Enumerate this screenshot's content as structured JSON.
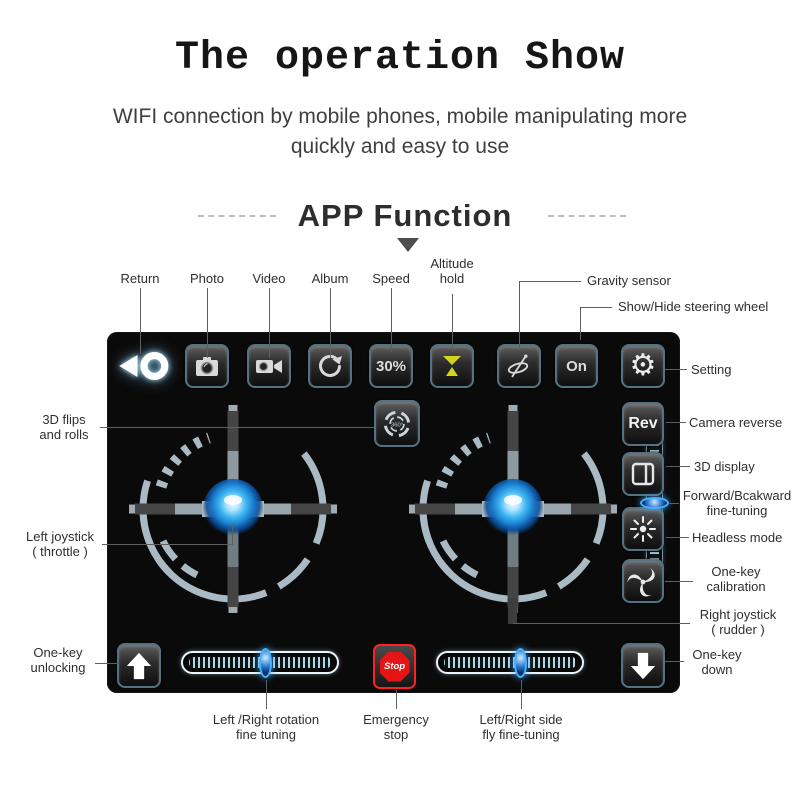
{
  "header": {
    "title": "The operation Show",
    "subtitle": "WIFI connection by mobile phones, mobile manipulating more\nquickly and easy to use",
    "section_heading": "APP Function"
  },
  "app": {
    "speed_button": "30%",
    "steering_toggle": "On",
    "camera_reverse_button": "Rev",
    "emergency_stop_button": "Stop",
    "flip_badge": "360°"
  },
  "annotations": {
    "top": {
      "return": "Return",
      "photo": "Photo",
      "video": "Video",
      "album": "Album",
      "speed": "Speed",
      "altitude": "Altitude\nhold",
      "gravity": "Gravity sensor",
      "steering": "Show/Hide steering wheel"
    },
    "left": {
      "flips": "3D flips\nand rolls",
      "left_joystick": "Left joystick\n( throttle )",
      "unlock": "One-key\nunlocking"
    },
    "right": {
      "setting": "Setting",
      "camera_reverse": "Camera reverse",
      "display3d": "3D display",
      "fine_tune_fb": "Forward/Bcakward\nfine-tuning",
      "headless": "Headless mode",
      "calibration": "One-key\ncalibration",
      "right_joystick": "Right joystick\n( rudder )",
      "down": "One-key\ndown"
    },
    "bottom": {
      "rotation": "Left /Right rotation\nfine tuning",
      "emergency": "Emergency\nstop",
      "sidefly": "Left/Right side\nfly fine-tuning"
    }
  },
  "colors": {
    "panel_bg": "#0a0a0a",
    "button_border_teal": "#527482",
    "joystick_ring": "#a9bac4",
    "knob_blue": "#2196f3",
    "slider_handle_blue": "#49b0ff",
    "altitude_yellow": "#d4d41a",
    "stop_red": "#e61515",
    "label_text": "#2f2f2f"
  }
}
